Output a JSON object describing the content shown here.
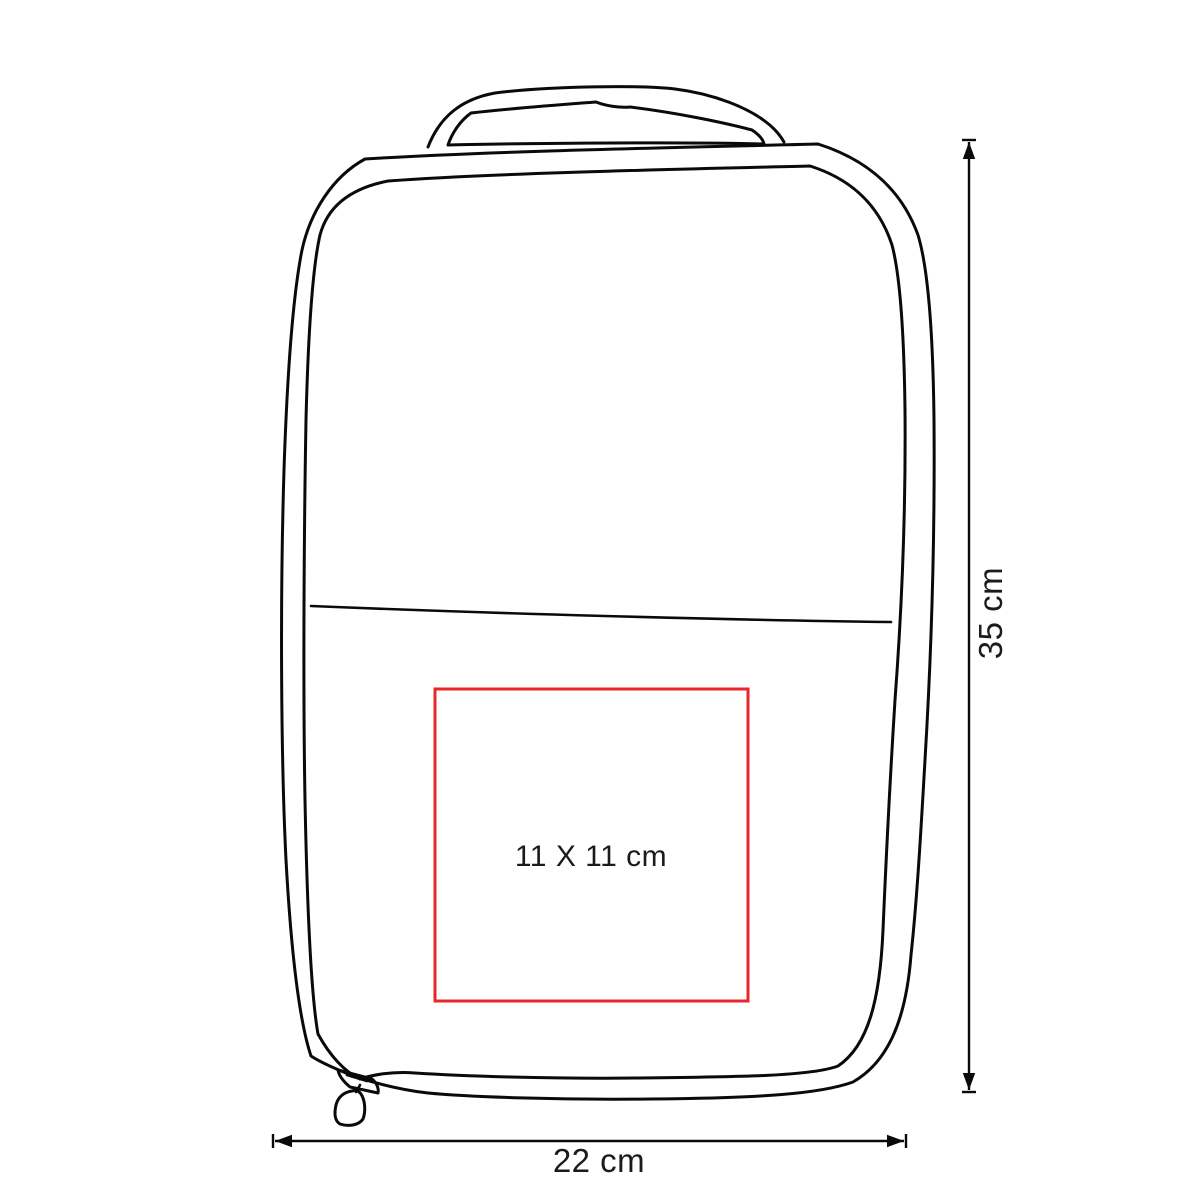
{
  "diagram": {
    "figure": "bag-outline-drawing",
    "measurements": {
      "height_label": "35 cm",
      "width_label": "22 cm",
      "print_area_label": "11 X 11 cm"
    },
    "colors": {
      "outline": "#0a0a0a",
      "print_area_border": "#e8262b",
      "text": "#1b1b1b",
      "background": "#ffffff"
    }
  }
}
